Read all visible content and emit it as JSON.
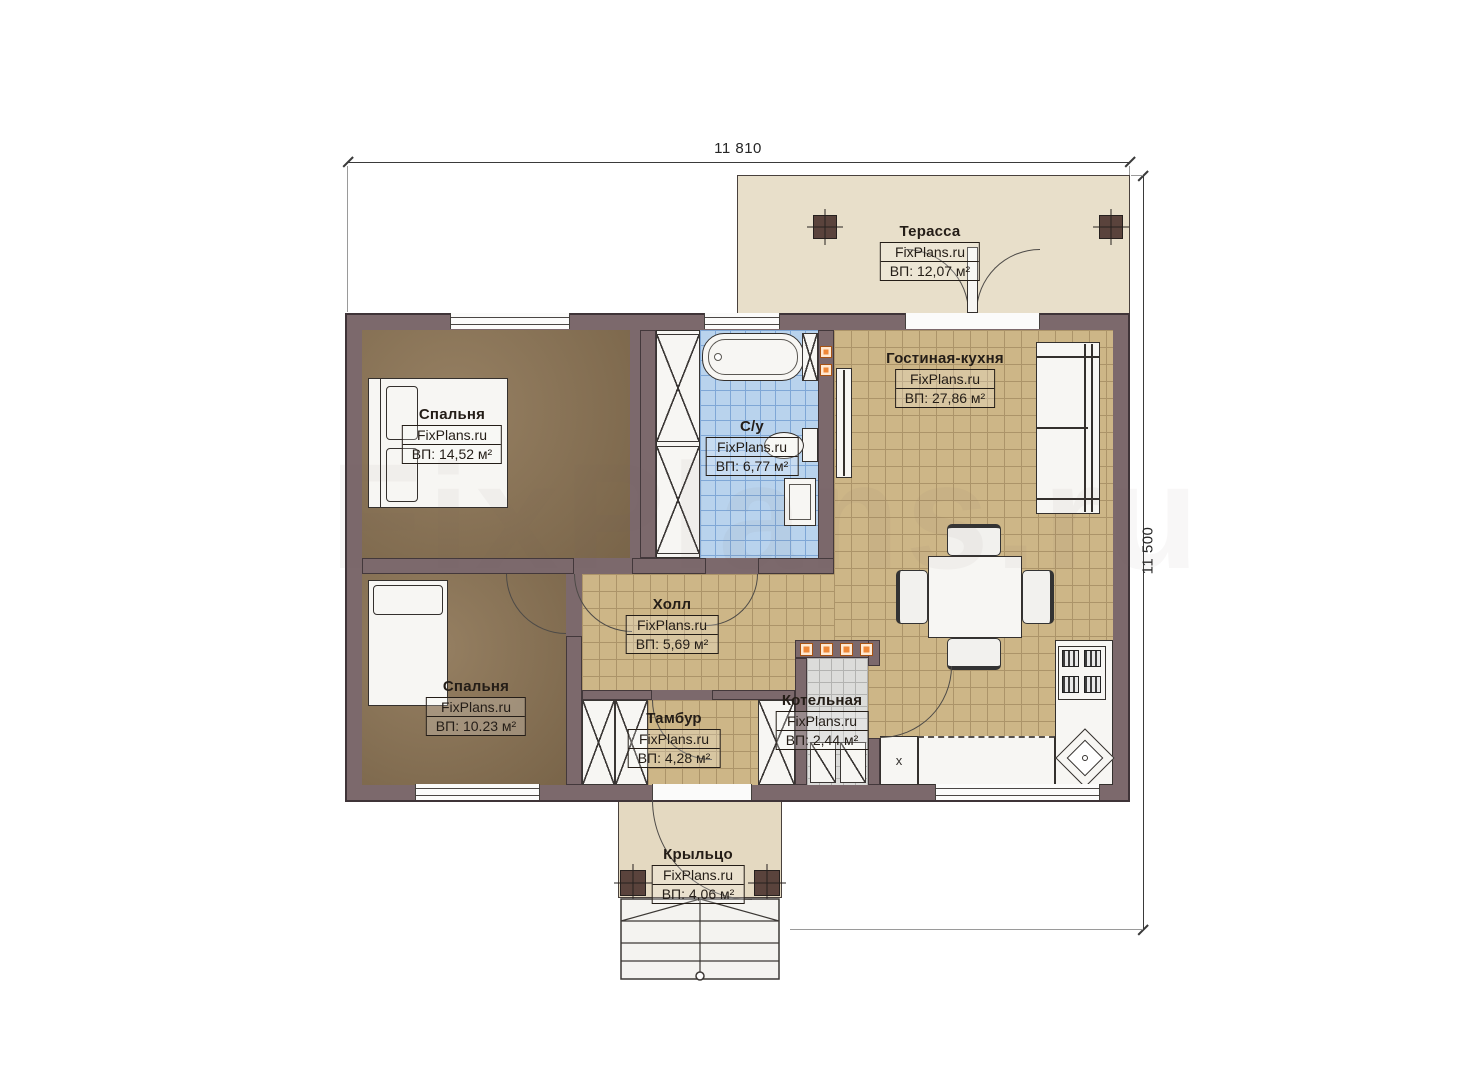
{
  "brand": "FixPlans.ru",
  "dimensions": {
    "width": "11 810",
    "height": "11 500"
  },
  "rooms": {
    "terrace": {
      "name": "Терасса",
      "brand": "FixPlans.ru",
      "area": "ВП: 12,07 м²"
    },
    "living": {
      "name": "Гостиная-кухня",
      "brand": "FixPlans.ru",
      "area": "ВП: 27,86 м²"
    },
    "bedroom1": {
      "name": "Спальня",
      "brand": "FixPlans.ru",
      "area": "ВП: 14,52 м²"
    },
    "bathroom": {
      "name": "С/у",
      "brand": "FixPlans.ru",
      "area": "ВП: 6,77 м²"
    },
    "hall": {
      "name": "Холл",
      "brand": "FixPlans.ru",
      "area": "ВП: 5,69 м²"
    },
    "bedroom2": {
      "name": "Спальня",
      "brand": "FixPlans.ru",
      "area": "ВП: 10.23 м²"
    },
    "tambour": {
      "name": "Тамбур",
      "brand": "FixPlans.ru",
      "area": "ВП: 4,28 м²"
    },
    "boiler": {
      "name": "Котельная",
      "brand": "FixPlans.ru",
      "area": "ВП: 2,44 м²"
    },
    "porch": {
      "name": "Крыльцо",
      "brand": "FixPlans.ru",
      "area": "ВП: 4,06 м²"
    }
  },
  "annotations": {
    "closet_mark": "х"
  },
  "colors": {
    "wall": "#7c696c",
    "floor_wood": "#8d7555",
    "floor_tile_living": "#cdb687",
    "floor_tile_bath": "#b9d3ed",
    "floor_tile_boiler": "#dcdcda",
    "terrace": "#e8dfca",
    "accent_orange": "#ef8837"
  }
}
